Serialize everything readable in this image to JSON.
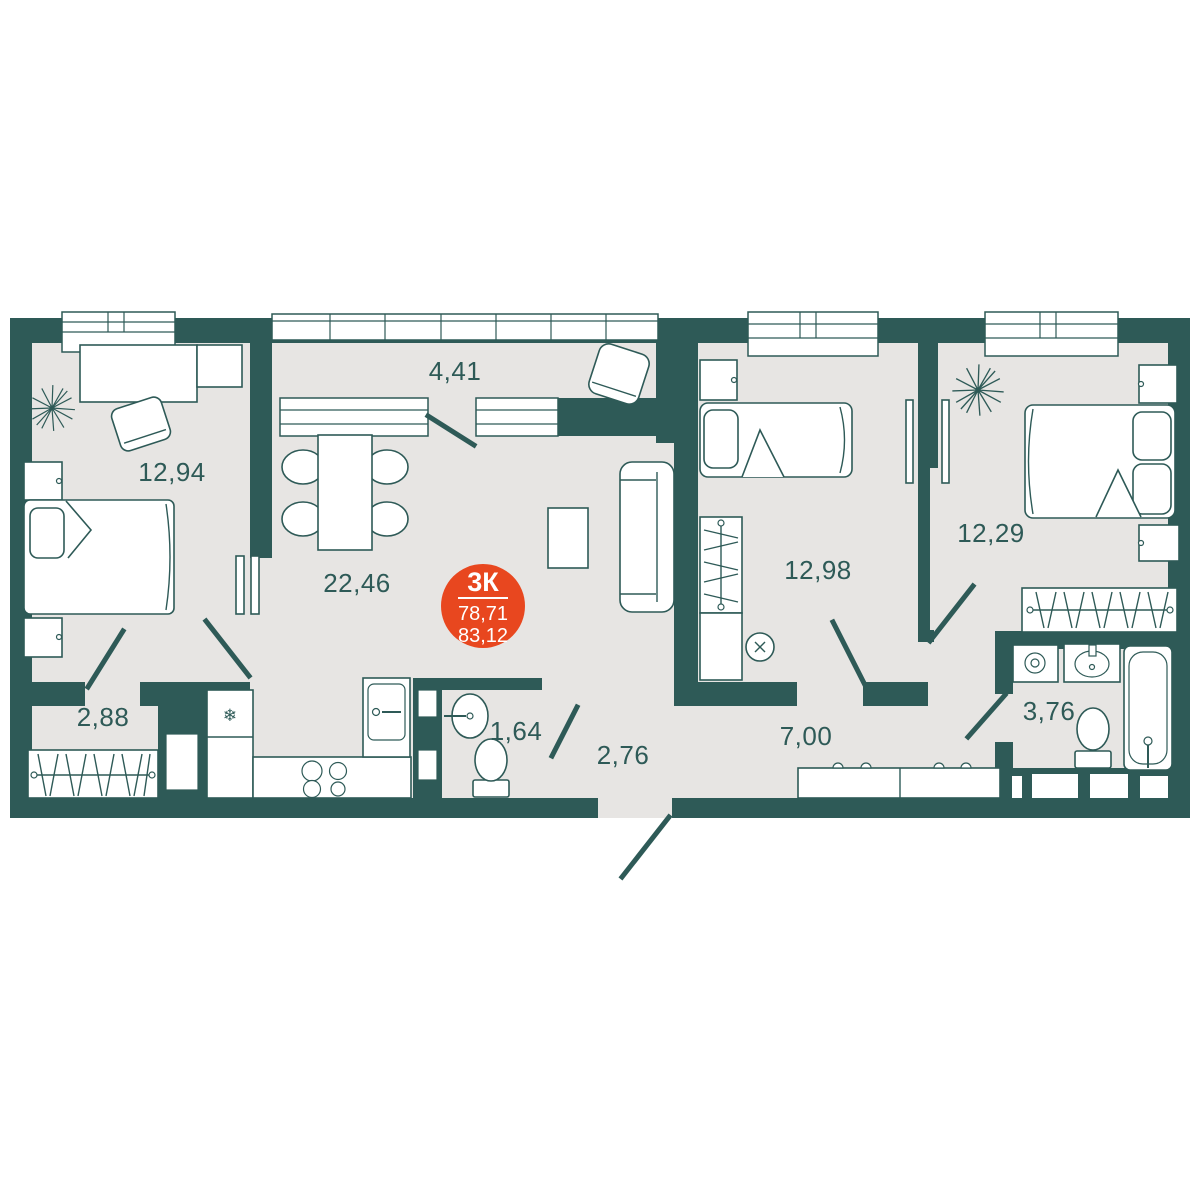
{
  "plan": {
    "badge": {
      "type": "3К",
      "area_living": "78,71",
      "area_total": "83,12"
    },
    "rooms": [
      {
        "name": "bedroom-1",
        "area": "12,94"
      },
      {
        "name": "loggia",
        "area": "4,41"
      },
      {
        "name": "living-kitchen",
        "area": "22,46"
      },
      {
        "name": "bedroom-2",
        "area": "12,98"
      },
      {
        "name": "bedroom-3",
        "area": "12,29"
      },
      {
        "name": "wardrobe-hall",
        "area": "2,88"
      },
      {
        "name": "bathroom-guest",
        "area": "1,64"
      },
      {
        "name": "hallway",
        "area": "2,76"
      },
      {
        "name": "corridor",
        "area": "7,00"
      },
      {
        "name": "bathroom-main",
        "area": "3,76"
      }
    ],
    "icons": {
      "snowflake": "❄"
    },
    "colors": {
      "wall": "#2E5A57",
      "floor": "#E7E5E3",
      "badge": "#E8471F",
      "furniture": "#FFFFFF",
      "background": "#FFFFFF"
    }
  }
}
